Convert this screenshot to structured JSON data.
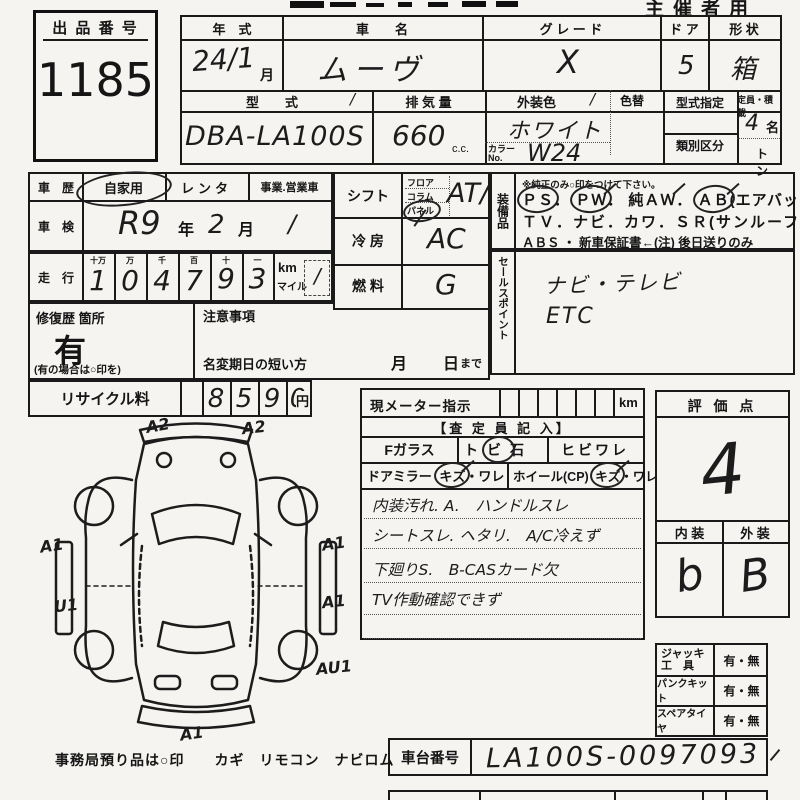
{
  "header": {
    "organizer_label": "主催者用"
  },
  "auction_no": {
    "label": "出 品 番 号",
    "value": "1185"
  },
  "vehicle": {
    "year_label": "年　式",
    "year_value": "24/1",
    "month_unit": "月",
    "name_label": "車　　名",
    "name_value": "ムーヴ",
    "grade_label": "グ レ ー ド",
    "grade_value": "X",
    "door_label": "ド ア",
    "door_value": "5",
    "shape_label": "形 状",
    "shape_value": "箱",
    "model_label": "型　　式",
    "model_tick": "/",
    "model_value": "DBA-LA100S",
    "disp_label": "排 気 量",
    "disp_value": "660",
    "disp_unit": "c.c.",
    "color_label": "外装色",
    "color_tick": "/",
    "color_change_label": "色替",
    "color_value": "ホワイト",
    "color_no_label": "カラーNo.",
    "color_no_value": "W24",
    "type_desig_label": "型式指定",
    "class_label": "類別区分",
    "capacity_label": "定員・積載",
    "capacity_value": "4",
    "capacity_unit": "名",
    "ton_label": "トン"
  },
  "history": {
    "label": "車　歴",
    "opt1": "自家用",
    "opt2": "レンタ",
    "opt3": "事業.営業車"
  },
  "inspection": {
    "label": "車　検",
    "era": "R9",
    "year_unit": "年",
    "month": "2",
    "month_unit": "月",
    "tick": "/"
  },
  "mileage": {
    "label": "走　行",
    "h1": "十万",
    "h2": "万",
    "h3": "千",
    "h4": "百",
    "h5": "十",
    "h6": "一",
    "d1": "1",
    "d2": "0",
    "d3": "4",
    "d4": "7",
    "d5": "9",
    "d6": "3",
    "km": "km",
    "mile": "マイル",
    "tick": "/"
  },
  "repair": {
    "label": "修復歴 箇所",
    "value": "有",
    "note": "(有の場合は○印を)"
  },
  "caution": {
    "label": "注意事項",
    "name_change": "名変期日の短い方",
    "month": "月",
    "day": "日",
    "made": "まで"
  },
  "recycle": {
    "label": "リサイクル料",
    "d1": "8",
    "d2": "5",
    "d3": "9",
    "d4": "0",
    "unit": "円"
  },
  "controls": {
    "shift_label": "シフト",
    "shift_opt1": "フロア",
    "shift_opt2": "コラム",
    "shift_opt3": "パネル",
    "shift_value": "AT/",
    "ac_label": "冷 房",
    "ac_value": "AC",
    "fuel_label": "燃 料",
    "fuel_value": "G"
  },
  "equipment": {
    "label": "装備品",
    "note": "※純正のみ○印をつけて下さい。",
    "ps": "ＰＳ",
    "sep1": "．",
    "pw": "ＰＷ",
    "sep2": "．",
    "aw": "純ＡＷ",
    "sep3": "．",
    "ab": "ＡＢ",
    "ab_note": "(エアバック)",
    "line2": "ＴＶ．ナビ．カワ．ＳＲ(サンルーフ)",
    "line3": "ＡＢＳ ・ 新車保証書←(注) 後日送りのみ"
  },
  "sales": {
    "label": "セールスポイント",
    "line1": "ナビ・テレビ",
    "line2": "ETC"
  },
  "meter": {
    "label": "現メーター指示",
    "unit": "km",
    "header": "【査 定 員 記 入】",
    "fglass": "Fガラス",
    "tobi_a": "ト",
    "tobi_b": "ビ",
    "tobi_c": "石",
    "hibi": "ヒビワレ",
    "mirror": "ドアミラー",
    "mirror_opt_a": "キズ",
    "mirror_opt_b": "・ワレ",
    "wheel": "ホイール(CP)",
    "wheel_opt_a": "キズ",
    "wheel_opt_b": "・ワレ",
    "note1": "内装汚れ. A.　ハンドルスレ",
    "note2": "シートスレ. ヘタリ.　A/C冷えず",
    "note3": "下廻りS.　B-CASカード欠",
    "note4": "TV作動確認できず"
  },
  "evaluation": {
    "label": "評 価 点",
    "score": "4",
    "interior_label": "内 装",
    "exterior_label": "外 装",
    "interior": "b",
    "exterior": "B"
  },
  "accessories": {
    "jack1": "ジャッキ",
    "jack2": "工　具",
    "jack_v": "有・無",
    "puncture": "パンクキット",
    "puncture_v": "有・無",
    "spare": "スペアタイヤ",
    "spare_v": "有・無"
  },
  "chassis": {
    "label": "車台番号",
    "value": "LA100S-0097093"
  },
  "office_note": "事務局預り品は○印　　カギ　リモコン　ナビロム",
  "diagram": {
    "a_tl": "A2",
    "a_tr": "A2",
    "a_l1": "A1",
    "a_l2": "U1",
    "a_r1": "A1",
    "a_r2": "A1",
    "a_r3": "AU1",
    "a_b": "A1"
  }
}
